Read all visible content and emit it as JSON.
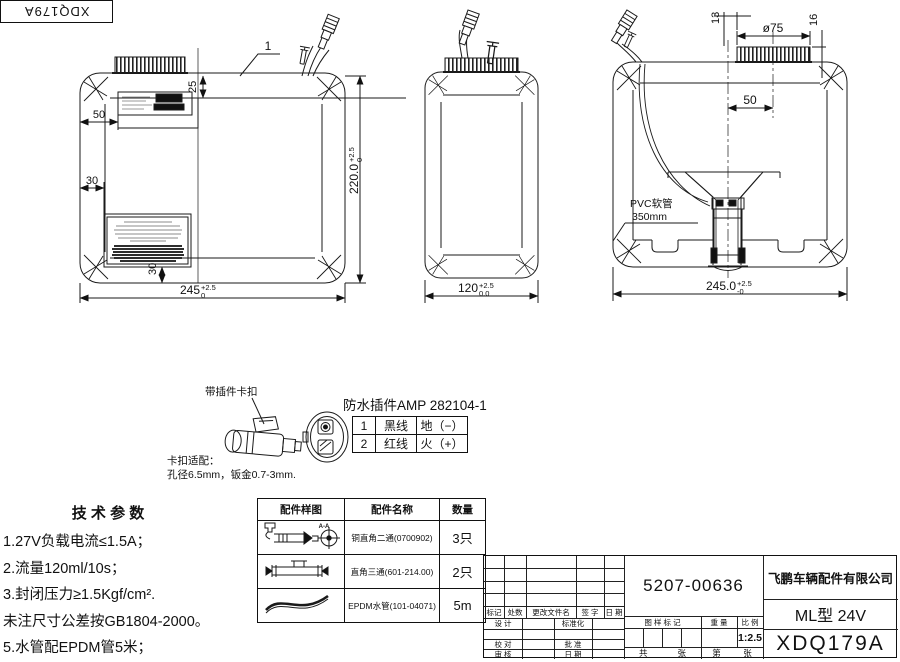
{
  "frame_code": "XDQ179A",
  "views": {
    "front": {
      "callout_number": "1",
      "dim_cap_offset": "25",
      "dim_label_offset": "50",
      "dim_big_label_offset": "30",
      "dim_big_label_bottom": "30",
      "dim_height": {
        "value": "220.0",
        "tol_up": "+2.5",
        "tol_down": "0"
      },
      "dim_width": {
        "value": "245",
        "tol_up": "+2.5",
        "tol_down": "0"
      }
    },
    "side": {
      "dim_width": {
        "value": "120",
        "tol_up": "+2.5",
        "tol_down": "0.0"
      }
    },
    "rear": {
      "dim_cap_diameter": "ø75",
      "dim_cap_edge_offset": "13",
      "dim_cap_height": "16",
      "dim_cap_to_pump": "50",
      "dim_width": {
        "value": "245.0",
        "tol_up": "+2.5",
        "tol_down": "-0"
      },
      "hose_label_line1": "PVC软管",
      "hose_label_line2": "350mm"
    }
  },
  "connector_detail": {
    "clip_callout": "带插件卡扣",
    "title": "防水插件AMP 282104-1",
    "pin_table": {
      "rows": [
        {
          "pin": "1",
          "wire": "黑线",
          "polarity": "地（−）"
        },
        {
          "pin": "2",
          "wire": "红线",
          "polarity": "火（+）"
        }
      ]
    },
    "clip_fit_title": "卡扣适配：",
    "clip_fit_spec": "孔径6.5mm，钣金0.7-3mm."
  },
  "technical_parameters": {
    "title": "技 术 参 数",
    "items": [
      "1.27V负载电流≤1.5A；",
      "2.流量120ml/10s；",
      "3.封闭压力≥1.5Kgf/cm².",
      "未注尺寸公差按GB1804-2000。",
      "5.水管配EPDM管5米；"
    ]
  },
  "parts_table": {
    "headers": [
      "配件样图",
      "配件名称",
      "数量"
    ],
    "section_mark": "A-A",
    "rows": [
      {
        "sketch": "elbow-fitting",
        "name": "铜直角二通(0700902)",
        "qty": "3只"
      },
      {
        "sketch": "tee-fitting",
        "name": "直角三通(601-214.00)",
        "qty": "2只"
      },
      {
        "sketch": "epdm-hose",
        "name": "EPDM水管(101-04071)",
        "qty": "5m"
      }
    ]
  },
  "title_block": {
    "part_number": "5207-00636",
    "company": "飞鹏车辆配件有限公司",
    "model": "ML型 24V",
    "drawing_number": "XDQ179A",
    "scale_value": "1:2.5",
    "revision_headers": [
      "标记",
      "处数",
      "更改文件名",
      "签  字",
      "日  期"
    ],
    "labels": {
      "design": "设  计",
      "standardization": "标准化",
      "proofread": "校  对",
      "approve": "批  准",
      "review": "审  核",
      "date": "日  期",
      "drawing_mark": "图 样 标 记",
      "weight": "重  量",
      "scale": "比  例",
      "sheet_total_prefix": "共",
      "sheet_total_suffix": "张",
      "sheet_page_prefix": "第",
      "sheet_page_suffix": "张"
    }
  }
}
